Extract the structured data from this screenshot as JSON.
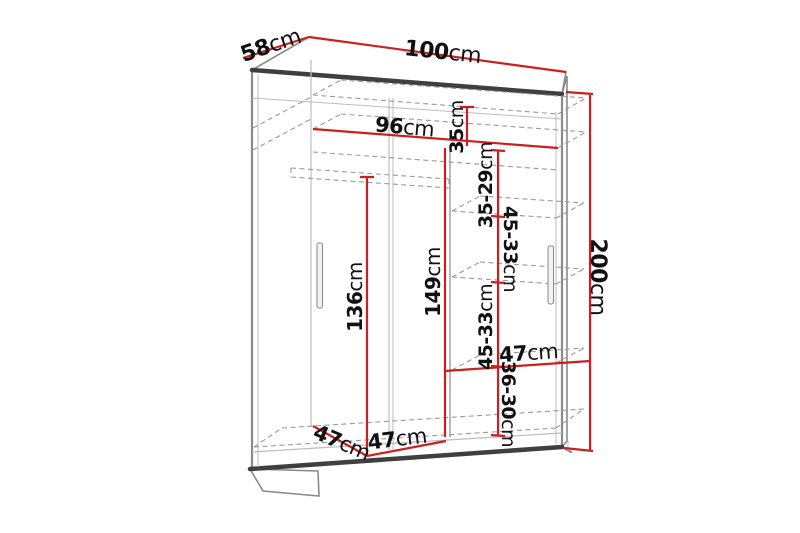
{
  "diagram_name": "wardrobe-dimension-diagram",
  "unit": "cm",
  "dimensions": {
    "overall": {
      "width": {
        "value": "100",
        "unit": "cm"
      },
      "depth": {
        "value": "58",
        "unit": "cm"
      },
      "height": {
        "value": "200",
        "unit": "cm"
      }
    },
    "interior": {
      "usable_width": {
        "value": "96",
        "unit": "cm"
      },
      "top_shelf_height": {
        "value": "35",
        "unit": "cm"
      },
      "upper_shelf_spacing": {
        "value": "35-29",
        "unit": "cm"
      },
      "middle_shelf_spacing_a": {
        "value": "45-33",
        "unit": "cm"
      },
      "middle_shelf_spacing_b": {
        "value": "45-33",
        "unit": "cm"
      },
      "lower_shelf_spacing": {
        "value": "36-30",
        "unit": "cm"
      },
      "shelf_column_height": {
        "value": "149",
        "unit": "cm"
      },
      "hanging_space_height": {
        "value": "136",
        "unit": "cm"
      },
      "shelf_width": {
        "value": "47",
        "unit": "cm"
      },
      "bottom_depth": {
        "value": "47",
        "unit": "cm"
      },
      "bottom_left_width": {
        "value": "47",
        "unit": "cm"
      }
    }
  },
  "colors": {
    "dimension_line": "#cc1f1f",
    "outline_dark": "#3f3f3f",
    "outline_mid": "#8a8a8a",
    "outline_light": "#bdbdbd",
    "dashed_line": "#9a9a9a",
    "text": "#111111",
    "background": "#ffffff",
    "side_panel_fill": "#e3e3e3"
  }
}
